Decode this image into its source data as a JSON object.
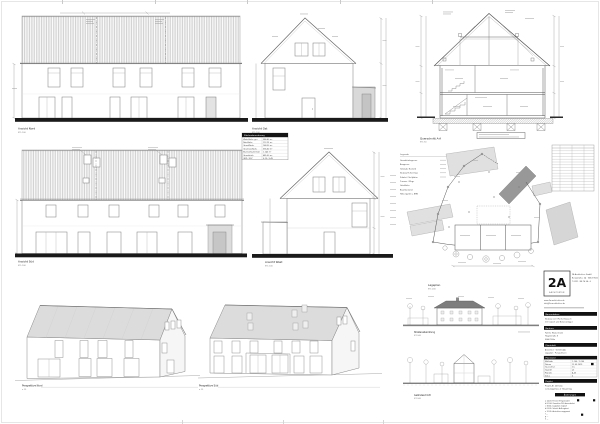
{
  "colors": {
    "paper": "#ffffff",
    "line": "#555555",
    "roof_hatch": "#a0a0a0",
    "fill_light": "#dcdcdc",
    "fill_dark": "#989898",
    "ground_bar": "#1a1a1a"
  },
  "drawings": {
    "front_elevation": {
      "title": "Ansicht Nord",
      "scale": "M 1:100"
    },
    "gable_elevation_east": {
      "title": "Ansicht Ost",
      "scale": "M 1:100"
    },
    "cross_section": {
      "title": "Querschnitt A-A",
      "scale": "M 1:50"
    },
    "rear_elevation": {
      "title": "Ansicht Süd",
      "scale": "M 1:100"
    },
    "gable_elevation_west": {
      "title": "Ansicht West",
      "scale": "M 1:100"
    },
    "site_plan": {
      "title": "Lageplan",
      "scale": "M 1:200"
    },
    "perspective_front": {
      "title": "Perspektive Nord",
      "scale": "o. M."
    },
    "perspective_rear": {
      "title": "Perspektive Süd",
      "scale": "o. M."
    },
    "street_elevation": {
      "title": "Straßenabwicklung",
      "scale": "M 1:500"
    },
    "terrain_section": {
      "title": "Geländeschnitt",
      "scale": "M 1:500"
    }
  },
  "area_table": {
    "header": "Flächenberechnung",
    "rows": [
      {
        "label": "Wohnfläche ges.",
        "value": "386,40 m²"
      },
      {
        "label": "Nutzfläche",
        "value": "112,25 m²"
      },
      {
        "label": "Grundfläche",
        "value": "168,30 m²"
      },
      {
        "label": "Geschossfläche",
        "value": "336,60 m²"
      },
      {
        "label": "Brutto-Rauminhalt",
        "value": "1.240 m³"
      },
      {
        "label": "Grundstück",
        "value": "685,00 m²"
      },
      {
        "label": "GRZ / GFZ",
        "value": "0,25 / 0,49"
      }
    ]
  },
  "site_plan_legend": {
    "header": "Legende",
    "rows": [
      "Grundstücksgrenze",
      "Baugrenze",
      "Gebäude Bestand",
      "Neubau Reihenhaus",
      "Zufahrt / Stellplätze",
      "Terrasse / Wege",
      "Grünfläche",
      "Baumbestand",
      "Höhenpunkt ü. NHN"
    ]
  },
  "title_block": {
    "logo_text": "2A",
    "logo_sub": "ARCHITEKTEN",
    "office_lines": [
      "2A Architekten GmbH",
      "Beispielallee 24 · 50672 Köln",
      "T 0221 / 98 76 54 - 0"
    ],
    "address_lines": [
      "www.2a-architekten.de",
      "info@2a-architekten.de"
    ],
    "sections": [
      {
        "header": "Bauvorhaben",
        "rows": [
          "Neubau von 3 Reihenhäusern",
          "mit Carport und Nebenanlagen"
        ]
      },
      {
        "header": "Bauherr",
        "rows": [
          "Familie Mustermann",
          "Hauptstraße 8",
          "50667 Köln"
        ]
      },
      {
        "header": "Planinhalt",
        "rows": [
          "Ansichten · Schnitt A-A",
          "Lageplan · Perspektiven"
        ]
      }
    ],
    "plan_table": {
      "header": "Planstand",
      "rows": [
        [
          "Maßstab",
          "1:100 / 1:200"
        ],
        [
          "Datum",
          "12.05.2019"
        ],
        [
          "Gezeichnet",
          "ms"
        ],
        [
          "Geprüft",
          "ak"
        ],
        [
          "Plan-Nr.",
          "A-03"
        ],
        [
          "Index",
          "b"
        ]
      ]
    },
    "info_section": {
      "header": "Projekt",
      "rows": [
        "Projekt-Nr. 2019-14",
        "Leistungsphase 4 · Bauantrag"
      ]
    },
    "revision": {
      "header": "Änderungen",
      "rows": [
        "a  14.03.  Fenster EG geändert",
        "b  02.04.  Grundriss DG überarbeitet",
        "c  18.04.  Lageplan ergänzt",
        "d  03.05.  Schnitt A-A ergänzt",
        "e  12.05.  Ansichten angepasst",
        "f  —",
        "g  —",
        "h  —"
      ]
    }
  }
}
